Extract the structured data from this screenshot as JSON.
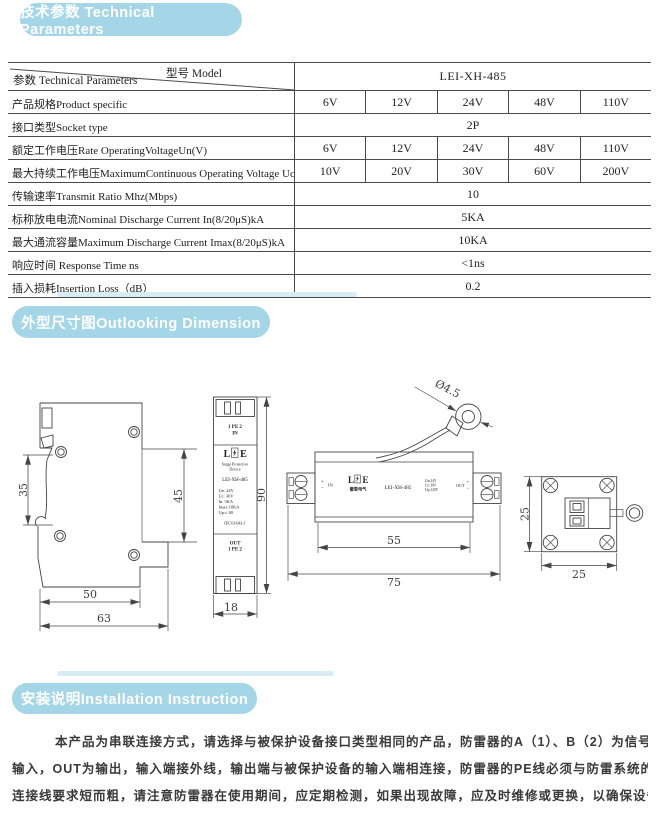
{
  "sections": {
    "tech_title": "技术参数 Technical Parameters",
    "dim_title": "外型尺寸图Outlooking Dimension",
    "install_title": "安装说明Installation Instruction"
  },
  "table": {
    "corner_top": "型号 Model",
    "corner_bottom": "参数 Technical Parameters",
    "model": "LEI-XH-485",
    "rows": [
      {
        "label": "产品规格Product specific",
        "values": [
          "6V",
          "12V",
          "24V",
          "48V",
          "110V"
        ]
      },
      {
        "label": "接口类型Socket type",
        "merged": "2P"
      },
      {
        "label": "额定工作电压Rate OperatingVoltageUn(V)",
        "values": [
          "6V",
          "12V",
          "24V",
          "48V",
          "110V"
        ]
      },
      {
        "label": "最大持续工作电压MaximumContinuous Operating Voltage Uc",
        "values": [
          "10V",
          "20V",
          "30V",
          "60V",
          "200V"
        ]
      },
      {
        "label": "传输速率Transmit Ratio Mhz(Mbps)",
        "merged": "10"
      },
      {
        "label": "标称放电电流Nominal Discharge Current In(8/20μS)kA",
        "merged": "5KA"
      },
      {
        "label": "最大通流容量Maximum Discharge Current Imax(8/20μS)kA",
        "merged": "10KA"
      },
      {
        "label": "响应时间 Response Time ns",
        "merged": "<1ns"
      },
      {
        "label": "插入损耗Insertion Loss（dB）",
        "merged": "0.2"
      }
    ]
  },
  "drawings": {
    "side": {
      "d35": "35",
      "d45": "45",
      "d50": "50",
      "d63": "63"
    },
    "front": {
      "top1": "1 PE 2",
      "top2": "IN",
      "logo_l": "L",
      "logo_e": "E",
      "sub1": "Surge Protective",
      "sub2": "Device",
      "model": "LEI-XH-485",
      "spec1": "Un:  24V",
      "spec2": "Uc:  30V",
      "spec3": "In:  5KA",
      "spec4": "Imax:10KA",
      "spec5": "Up:≤ 60",
      "std": "IEC61643-1",
      "bot1": "OUT",
      "bot2": "1 PE 2",
      "d90": "90",
      "d18": "18"
    },
    "top": {
      "plus": "+",
      "minus": "−",
      "in": "IN",
      "logo_l": "L",
      "logo_e": "E",
      "logo_cn": "雷恩电气",
      "model": "LEI-XH-485",
      "spec1": "Un:24V",
      "spec2": "Uc:30V",
      "spec3": "Up:120V",
      "out": "OUT",
      "dia": "Ø4.5",
      "d55": "55",
      "d75": "75"
    },
    "end": {
      "d25v": "25",
      "d25h": "25"
    }
  },
  "install": {
    "line1": "本产品为串联连接方式，请选择与被保护设备接口类型相同的产品，防雷器的A（1）、B（2）为信号线的两极,IN为",
    "line2": "输入，OUT为输出，输入端接外线，输出端与被保护设备的输入端相连接，防雷器的PE线必须与防雷系统的地线可靠连接，",
    "line3": "连接线要求短而粗，请注意防雷器在使用期间，应定期检测，如果出现故障，应及时维修或更换，以确保设备安全。"
  }
}
